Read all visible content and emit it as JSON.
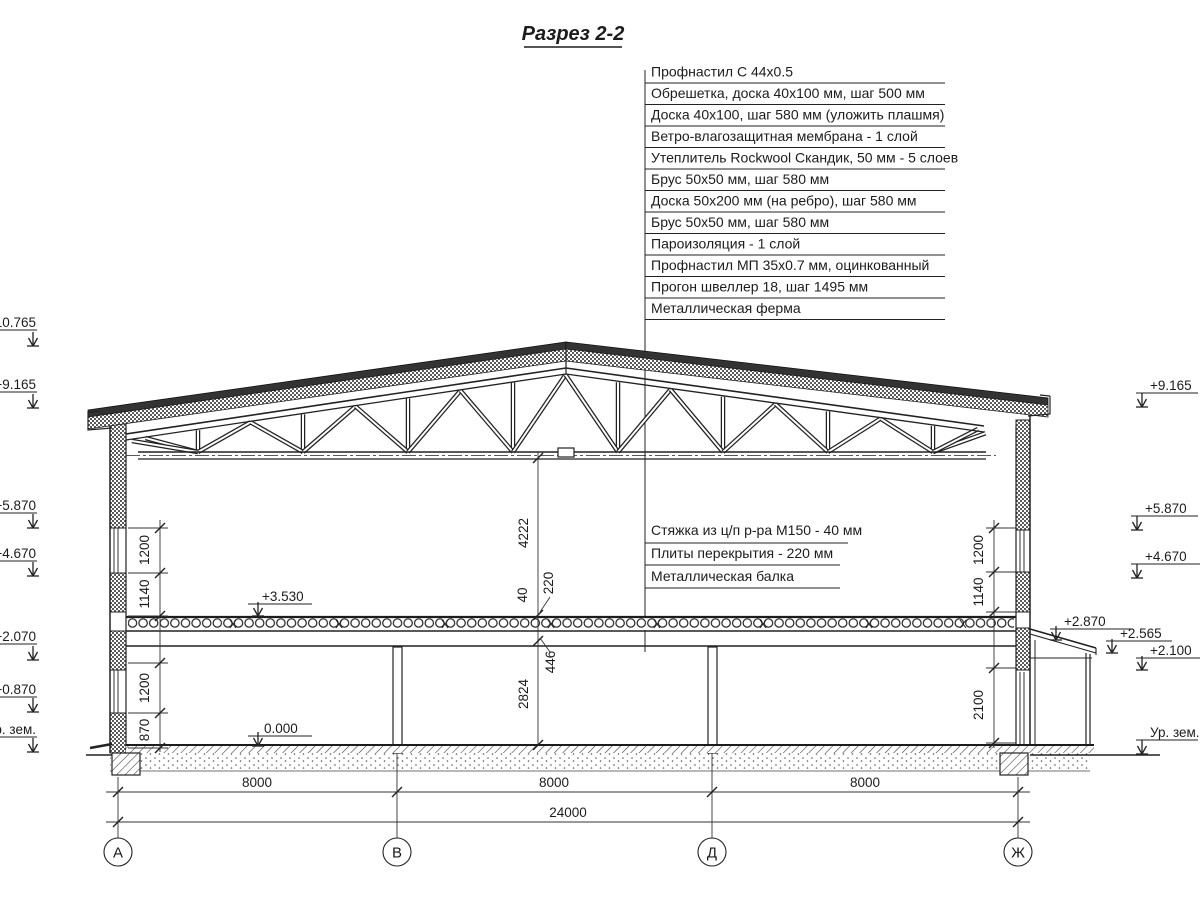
{
  "title": "Разрез 2-2",
  "roof_callouts": [
    "Профнастил С 44х0.5",
    "Обрешетка, доска 40х100 мм, шаг 500 мм",
    "Доска 40х100, шаг 580 мм (уложить плашмя)",
    "Ветро-влагозащитная мембрана - 1 слой",
    "Утеплитель Rockwool Скандик, 50 мм - 5 слоев",
    "Брус 50х50 мм, шаг 580 мм",
    "Доска 50х200 мм (на ребро), шаг 580 мм",
    "Брус 50х50 мм, шаг 580 мм",
    "Пароизоляция - 1 слой",
    "Профнастил МП 35х0.7 мм, оцинкованный",
    "Прогон швеллер 18, шаг 1495 мм",
    "Металлическая ферма"
  ],
  "floor_callouts": [
    "Стяжка из ц/п р-ра М150 - 40 мм",
    "Плиты перекрытия - 220 мм",
    "Металлическая балка"
  ],
  "left_marks": [
    "+10.765",
    "+9.165",
    "+5.870",
    "+4.670",
    "+2.070",
    "+0.870",
    "Ур. зем."
  ],
  "right_marks": [
    "+9.165",
    "+5.870",
    "+4.670",
    "+2.870",
    "+2.565",
    "+2.100",
    "Ур. зем."
  ],
  "level_marks": [
    "+3.530",
    "0.000"
  ],
  "dims": {
    "left": [
      "1200",
      "1140",
      "1200",
      "870"
    ],
    "right": [
      "1200",
      "1140",
      "2100"
    ],
    "center": [
      "4222",
      "40",
      "220",
      "446",
      "2824"
    ],
    "spans": [
      "8000",
      "8000",
      "8000"
    ],
    "total": "24000"
  },
  "axes": [
    "А",
    "В",
    "Д",
    "Ж"
  ]
}
